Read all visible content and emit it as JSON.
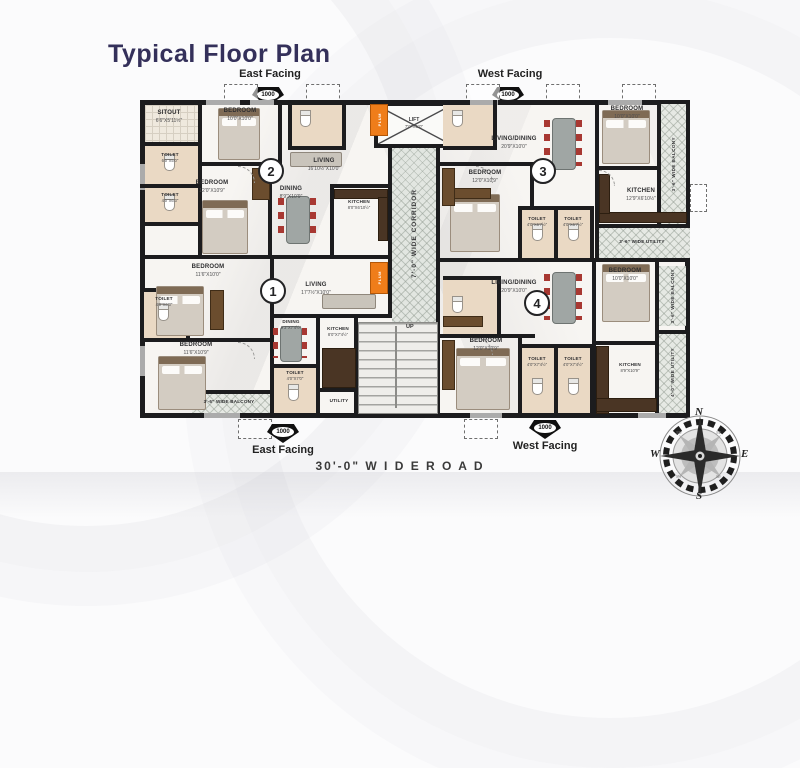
{
  "title": "Typical Floor Plan",
  "facing": {
    "top_left": "East Facing",
    "top_right": "West Facing",
    "bottom_left": "East Facing",
    "bottom_right": "West Facing",
    "marker": "1000"
  },
  "road_label": "30'-0\" W I D E   R O A D",
  "corridor": {
    "label": "7'-0\" WIDE CORRIDOR"
  },
  "lift": {
    "name": "LIFT",
    "dim": "7'0\"X5'0\""
  },
  "stairs": {
    "up": "UP"
  },
  "shaft": {
    "label": "PLUM"
  },
  "units": {
    "u1": "1",
    "u2": "2",
    "u3": "3",
    "u4": "4"
  },
  "compass": {
    "n": "N",
    "e": "E",
    "s": "S",
    "w": "W",
    "nw": "NW",
    "ne": "NE",
    "sw": "SW",
    "se": "SE"
  },
  "rooms": {
    "u2_sitout": {
      "name": "SITOUT",
      "dim": "6'6\"X5'11½\""
    },
    "u2_bedroom1": {
      "name": "BEDROOM",
      "dim": "10'0\"X10'0\""
    },
    "u2_toilet1": {
      "name": "TOILET",
      "dim": "6'0\"X5'0\""
    },
    "u2_toilet2": {
      "name": "TOILET",
      "dim": "4'0\"X6'3\""
    },
    "u2_bedroom2": {
      "name": "BEDROOM",
      "dim": "12'0\"X10'9\""
    },
    "u2_living": {
      "name": "LIVING",
      "dim": "16'10½\"X10'0\""
    },
    "u2_dining": {
      "name": "DINING",
      "dim": "8'9\"X10'9\""
    },
    "u2_kitchen": {
      "name": "KITCHEN",
      "dim": "8'0\"X6'10½\""
    },
    "u3_livingdining": {
      "name": "LIVING/DINING",
      "dim": "20'9\"X10'0\""
    },
    "u3_bedroom1": {
      "name": "BEDROOM",
      "dim": "10'0\"X10'0\""
    },
    "u3_bedroom2": {
      "name": "BEDROOM",
      "dim": "12'0\"X10'9\""
    },
    "u3_kitchen": {
      "name": "KITCHEN",
      "dim": "12'9\"X6'10½\""
    },
    "u3_toilet1": {
      "name": "TOILET",
      "dim": "4'0\"X6'7½\""
    },
    "u3_toilet2": {
      "name": "TOILET",
      "dim": "4'0\"X6'7½\""
    },
    "u3_balcony": {
      "name": "3'-6\" WIDE BALCONY"
    },
    "u3_utility": {
      "name": "3'-6\" WIDE UTILITY"
    },
    "u1_bedroom1": {
      "name": "BEDROOM",
      "dim": "11'6\"X10'0\""
    },
    "u1_toilet1": {
      "name": "TOILET",
      "dim": "4'0\"X6'3\""
    },
    "u1_living": {
      "name": "LIVING",
      "dim": "17'7½\"X10'0\""
    },
    "u1_bedroom2": {
      "name": "BEDROOM",
      "dim": "11'6\"X10'9\""
    },
    "u1_dining": {
      "name": "DINING",
      "dim": "9'3\"X7'4½\""
    },
    "u1_toilet2": {
      "name": "TOILET",
      "dim": "4'0\"X7'0\""
    },
    "u1_kitchen": {
      "name": "KITCHEN",
      "dim": "8'0\"X7'4½\""
    },
    "u1_balcony": {
      "name": "3'-6\" WIDE BALCONY"
    },
    "u1_utility": {
      "name": "UTILITY"
    },
    "u4_livingdining": {
      "name": "LIVING/DINING",
      "dim": "20'9\"X10'0\""
    },
    "u4_bedroom1": {
      "name": "BEDROOM",
      "dim": "12'0\"X10'9\""
    },
    "u4_toilet1": {
      "name": "TOILET",
      "dim": "4'0\"X7'4½\""
    },
    "u4_toilet2": {
      "name": "TOILET",
      "dim": "4'0\"X7'4½\""
    },
    "u4_kitchen": {
      "name": "KITCHEN",
      "dim": "8'9\"X10'9\""
    },
    "u4_bedroom2": {
      "name": "BEDROOM",
      "dim": "10'0\"X10'0\""
    },
    "u4_balcony": {
      "name": "3'-6\" WIDE BALCONY"
    },
    "u4_utility": {
      "name": "4'-0\" WIDE UTILITY"
    }
  },
  "colors": {
    "title": "#34305a",
    "wall": "#1c1c1e",
    "shaft_orange": "#ef7d1a",
    "chair_red": "#a83832"
  }
}
